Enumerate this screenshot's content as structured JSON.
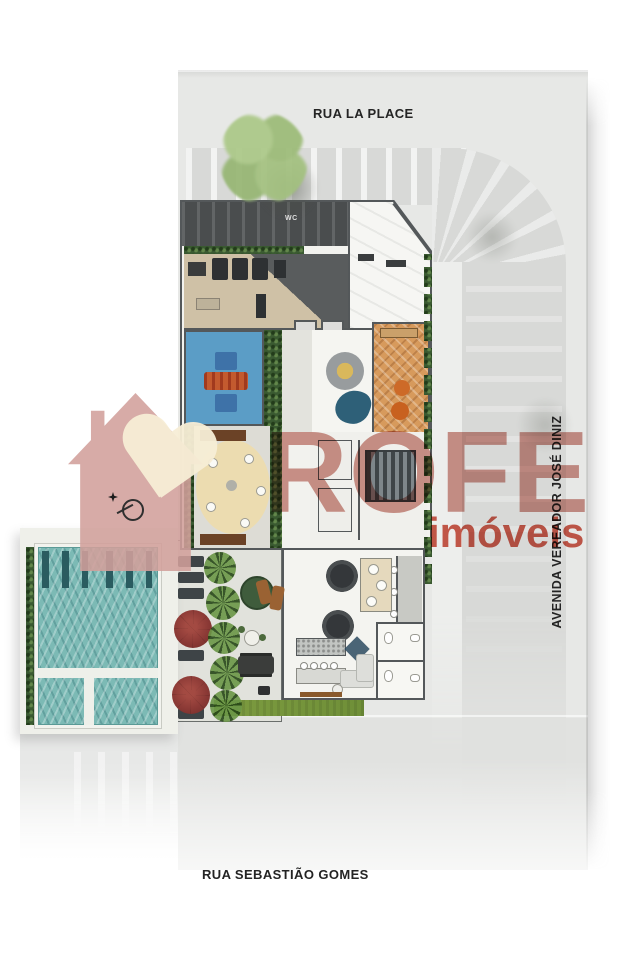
{
  "plan": {
    "streets": {
      "top": "RUA LA PLACE",
      "bottom": "RUA SEBASTIÃO GOMES",
      "right": "AVENIDA VEREADOR JOSÉ DINIZ"
    },
    "room_labels": {
      "wc": "WC"
    }
  },
  "watermark": {
    "brand": "ROFE",
    "tagline": "imóveis",
    "logo_icon": "house-heart-logo",
    "brand_color": "#c9837a",
    "tagline_color": "#c94534",
    "logo_rose": "#d2a09b",
    "heart_cream": "#f7eed6"
  },
  "compass": {
    "icon": "north-compass-icon"
  },
  "colors": {
    "road": "#d8d9d7",
    "plan_background": "#e7e8e6",
    "lap_pool_water": "#7cbab5",
    "kids_pool": "#5b9dc6",
    "play_table_orange": "#c35a2f",
    "wood_floor": "#d79a5c",
    "patio_cream": "#ecdcb0",
    "hedge_green": "#3a5a31",
    "grass_green": "#7d9c40",
    "umbrella_red": "#8c3a36",
    "tree_green": "#a6c383",
    "wall_gray": "#54585a"
  }
}
